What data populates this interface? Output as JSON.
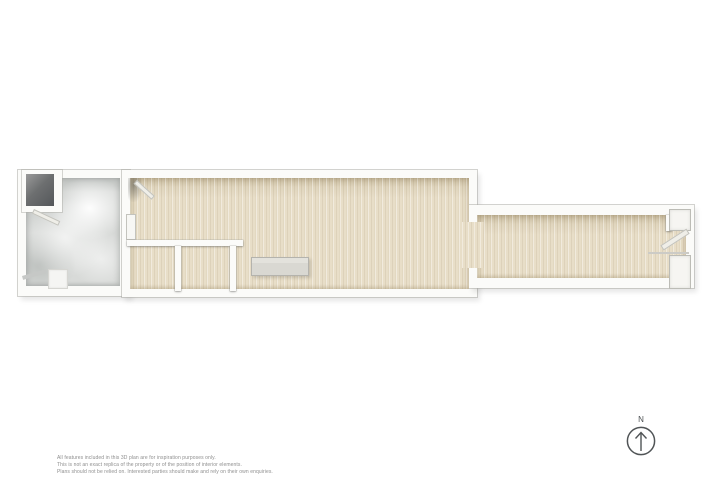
{
  "page": {
    "background": "#ffffff"
  },
  "disclaimer": {
    "lines": [
      "All features included in this 3D plan are for inspiration purposes only.",
      "This is not an exact replica of the property or of the position of interior elements.",
      "Plans should not be relied on. Interested parties should make and rely on their own enquiries."
    ]
  },
  "compass": {
    "label": "N"
  },
  "colors": {
    "wood_floor": "#e8dec8",
    "concrete_floor": "#d8dad8",
    "dark_alcove_floor": "#54575a",
    "wall": "#fbfbf9",
    "bench_top": "#deddd7",
    "compass_stroke": "#505456",
    "disclaimer_text": "#8e8e8e"
  }
}
